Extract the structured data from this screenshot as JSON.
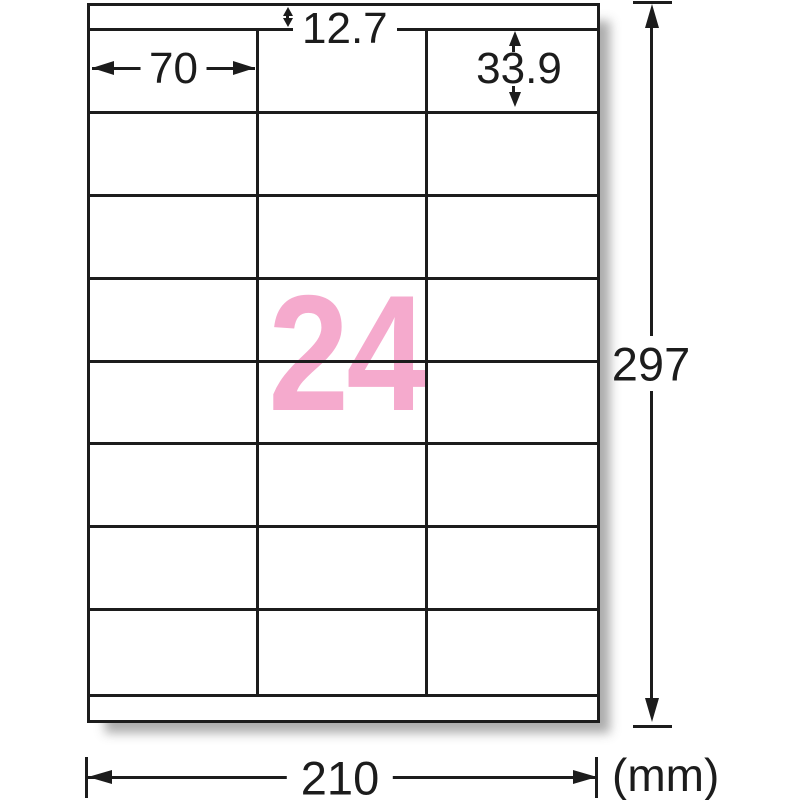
{
  "diagram": {
    "count": "24",
    "dims": {
      "top_margin": "12.7",
      "label_width": "70",
      "label_height": "33.9",
      "sheet_width": "210",
      "sheet_height": "297"
    },
    "unit": "(mm)",
    "grid": {
      "rows": 8,
      "columns": 3
    },
    "colors": {
      "count_pink": "#f5aacd",
      "line_black": "#1c1c1c"
    }
  }
}
